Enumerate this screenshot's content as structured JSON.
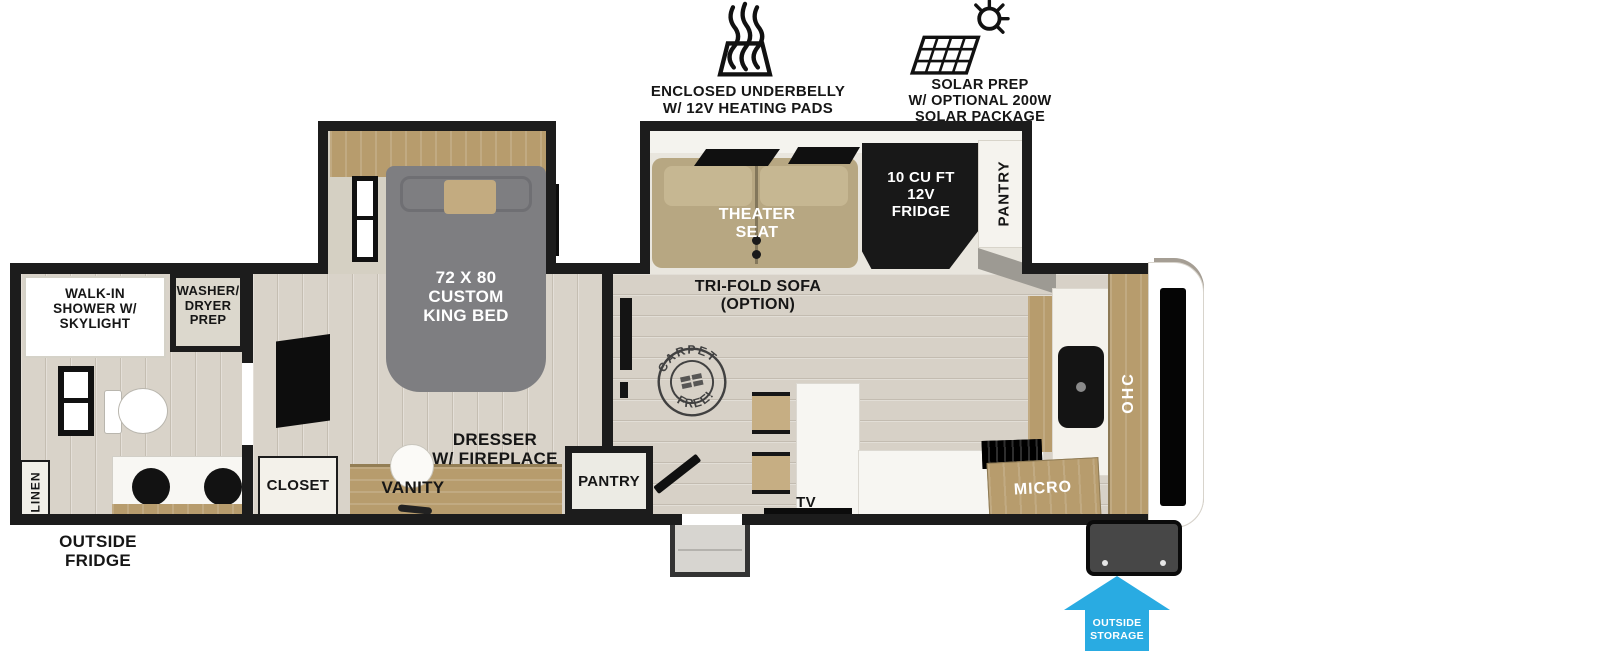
{
  "header": {
    "underbelly_label": "ENCLOSED UNDERBELLY\nW/ 12V HEATING PADS",
    "solar_label": "SOLAR PREP\nW/ OPTIONAL 200W\nSOLAR PACKAGE"
  },
  "bathroom": {
    "shower_label": "WALK-IN\nSHOWER W/\nSKYLIGHT",
    "washer_dryer_label": "WASHER/\nDRYER\nPREP",
    "linen_label": "LINEN",
    "outside_fridge_label": "OUTSIDE\nFRIDGE"
  },
  "bedroom": {
    "bed_label": "72 X 80\nCUSTOM\nKING BED",
    "closet_label": "CLOSET",
    "vanity_label": "VANITY",
    "dresser_label": "DRESSER\nW/ FIREPLACE",
    "pantry_label": "PANTRY"
  },
  "living": {
    "theater_seat_label": "THEATER\nSEAT",
    "trifold_label": "TRI-FOLD SOFA\n(OPTION)",
    "fridge_label": "10 CU FT\n12V\nFRIDGE",
    "pantry_label": "PANTRY",
    "stamp_top": "CARPET",
    "stamp_bottom": "FREE!"
  },
  "kitchen": {
    "tv_label": "TV",
    "micro_label": "MICRO",
    "ohc_label": "OHC"
  },
  "exterior": {
    "outside_storage_label": "OUTSIDE\nSTORAGE"
  },
  "colors": {
    "wall": "#1c1c1c",
    "floor": "#d7d1c7",
    "wood": "#b79c6d",
    "sofa_tan": "#b7a782",
    "bed_gray": "#7e7e81",
    "accent_blue": "#29abe2"
  }
}
